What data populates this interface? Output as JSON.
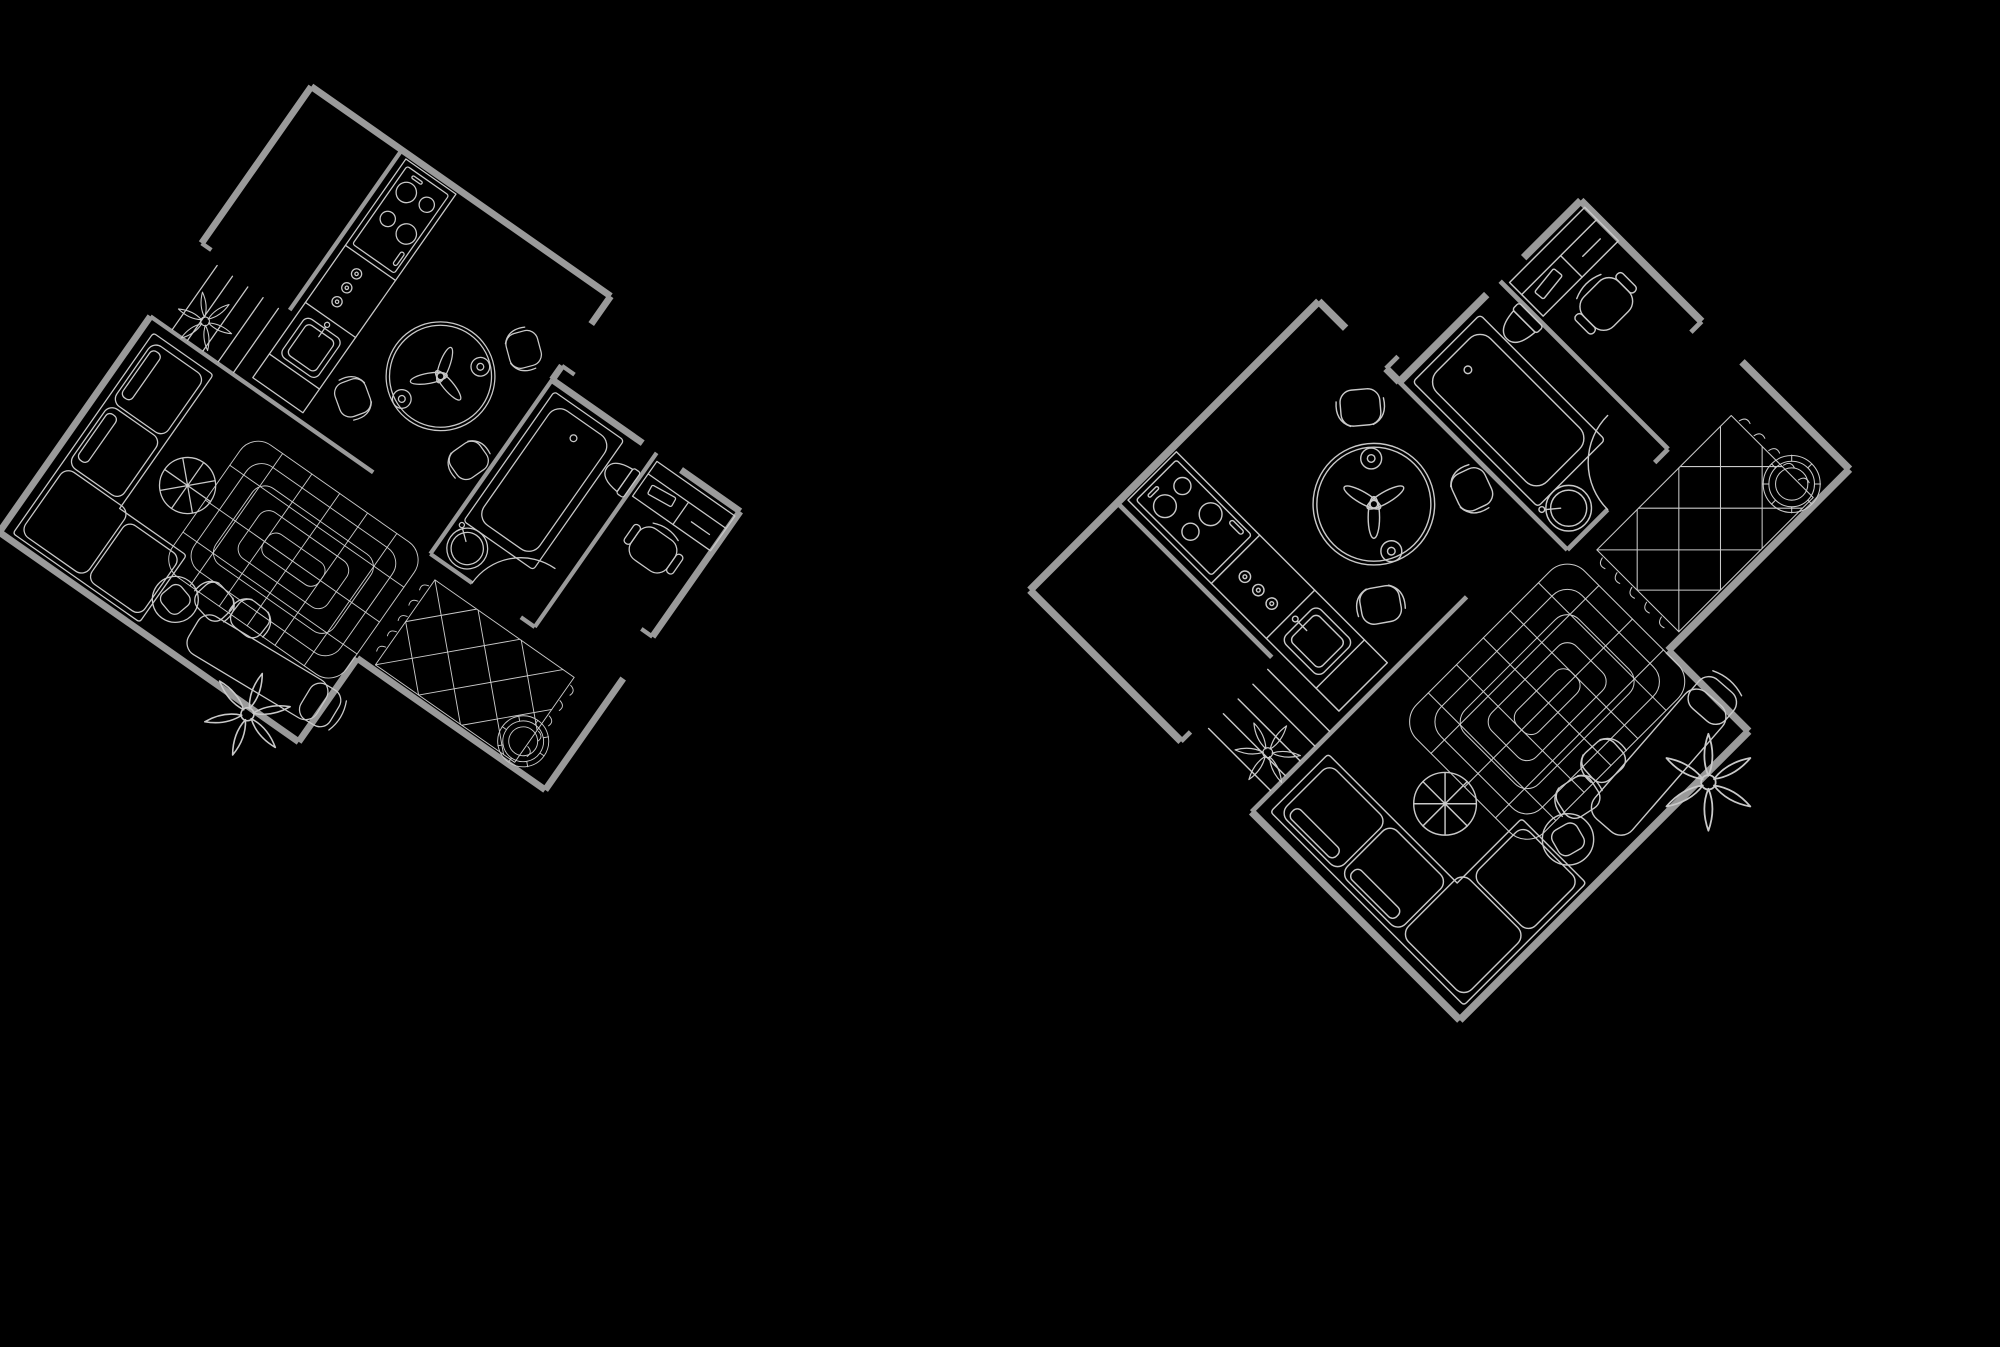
{
  "canvas": {
    "width": 2000,
    "height": 1347,
    "background_color": "#000000"
  },
  "style": {
    "wall_color": "#9a9a9a",
    "furniture_color": "#c9c9c9",
    "wall_stroke_px": 8,
    "furniture_stroke_px": 1.5
  },
  "plans": [
    {
      "id": "floor-plan-left",
      "rotation_deg": 35,
      "scale": 0.85,
      "center_x": 399,
      "center_y": 480,
      "mirrored": false
    },
    {
      "id": "floor-plan-right",
      "rotation_deg": -45,
      "scale": 0.95,
      "center_x": 1480,
      "center_y": 570,
      "mirrored": false
    }
  ],
  "rooms": [
    {
      "name": "kitchen",
      "furniture": [
        "counter",
        "stove-4-burners",
        "oven-knobs",
        "kitchen-sink"
      ]
    },
    {
      "name": "dining-area",
      "furniture": [
        "round-table",
        "table-centerpiece",
        "cups",
        "chair",
        "chair",
        "chair"
      ]
    },
    {
      "name": "entry",
      "furniture": [
        "stairs",
        "vine-plant"
      ]
    },
    {
      "name": "living-room",
      "furniture": [
        "corner-sofa",
        "layered-rug",
        "segmented-pouf",
        "long-table",
        "armchair",
        "side-chair",
        "side-chair",
        "tub-chair",
        "star-plant"
      ]
    },
    {
      "name": "bathroom",
      "furniture": [
        "bathtub",
        "round-washbasin",
        "toilet",
        "door-swing"
      ]
    },
    {
      "name": "bedroom-office",
      "furniture": [
        "desk",
        "desk-chair",
        "diamond-rug",
        "woven-basket"
      ]
    }
  ]
}
